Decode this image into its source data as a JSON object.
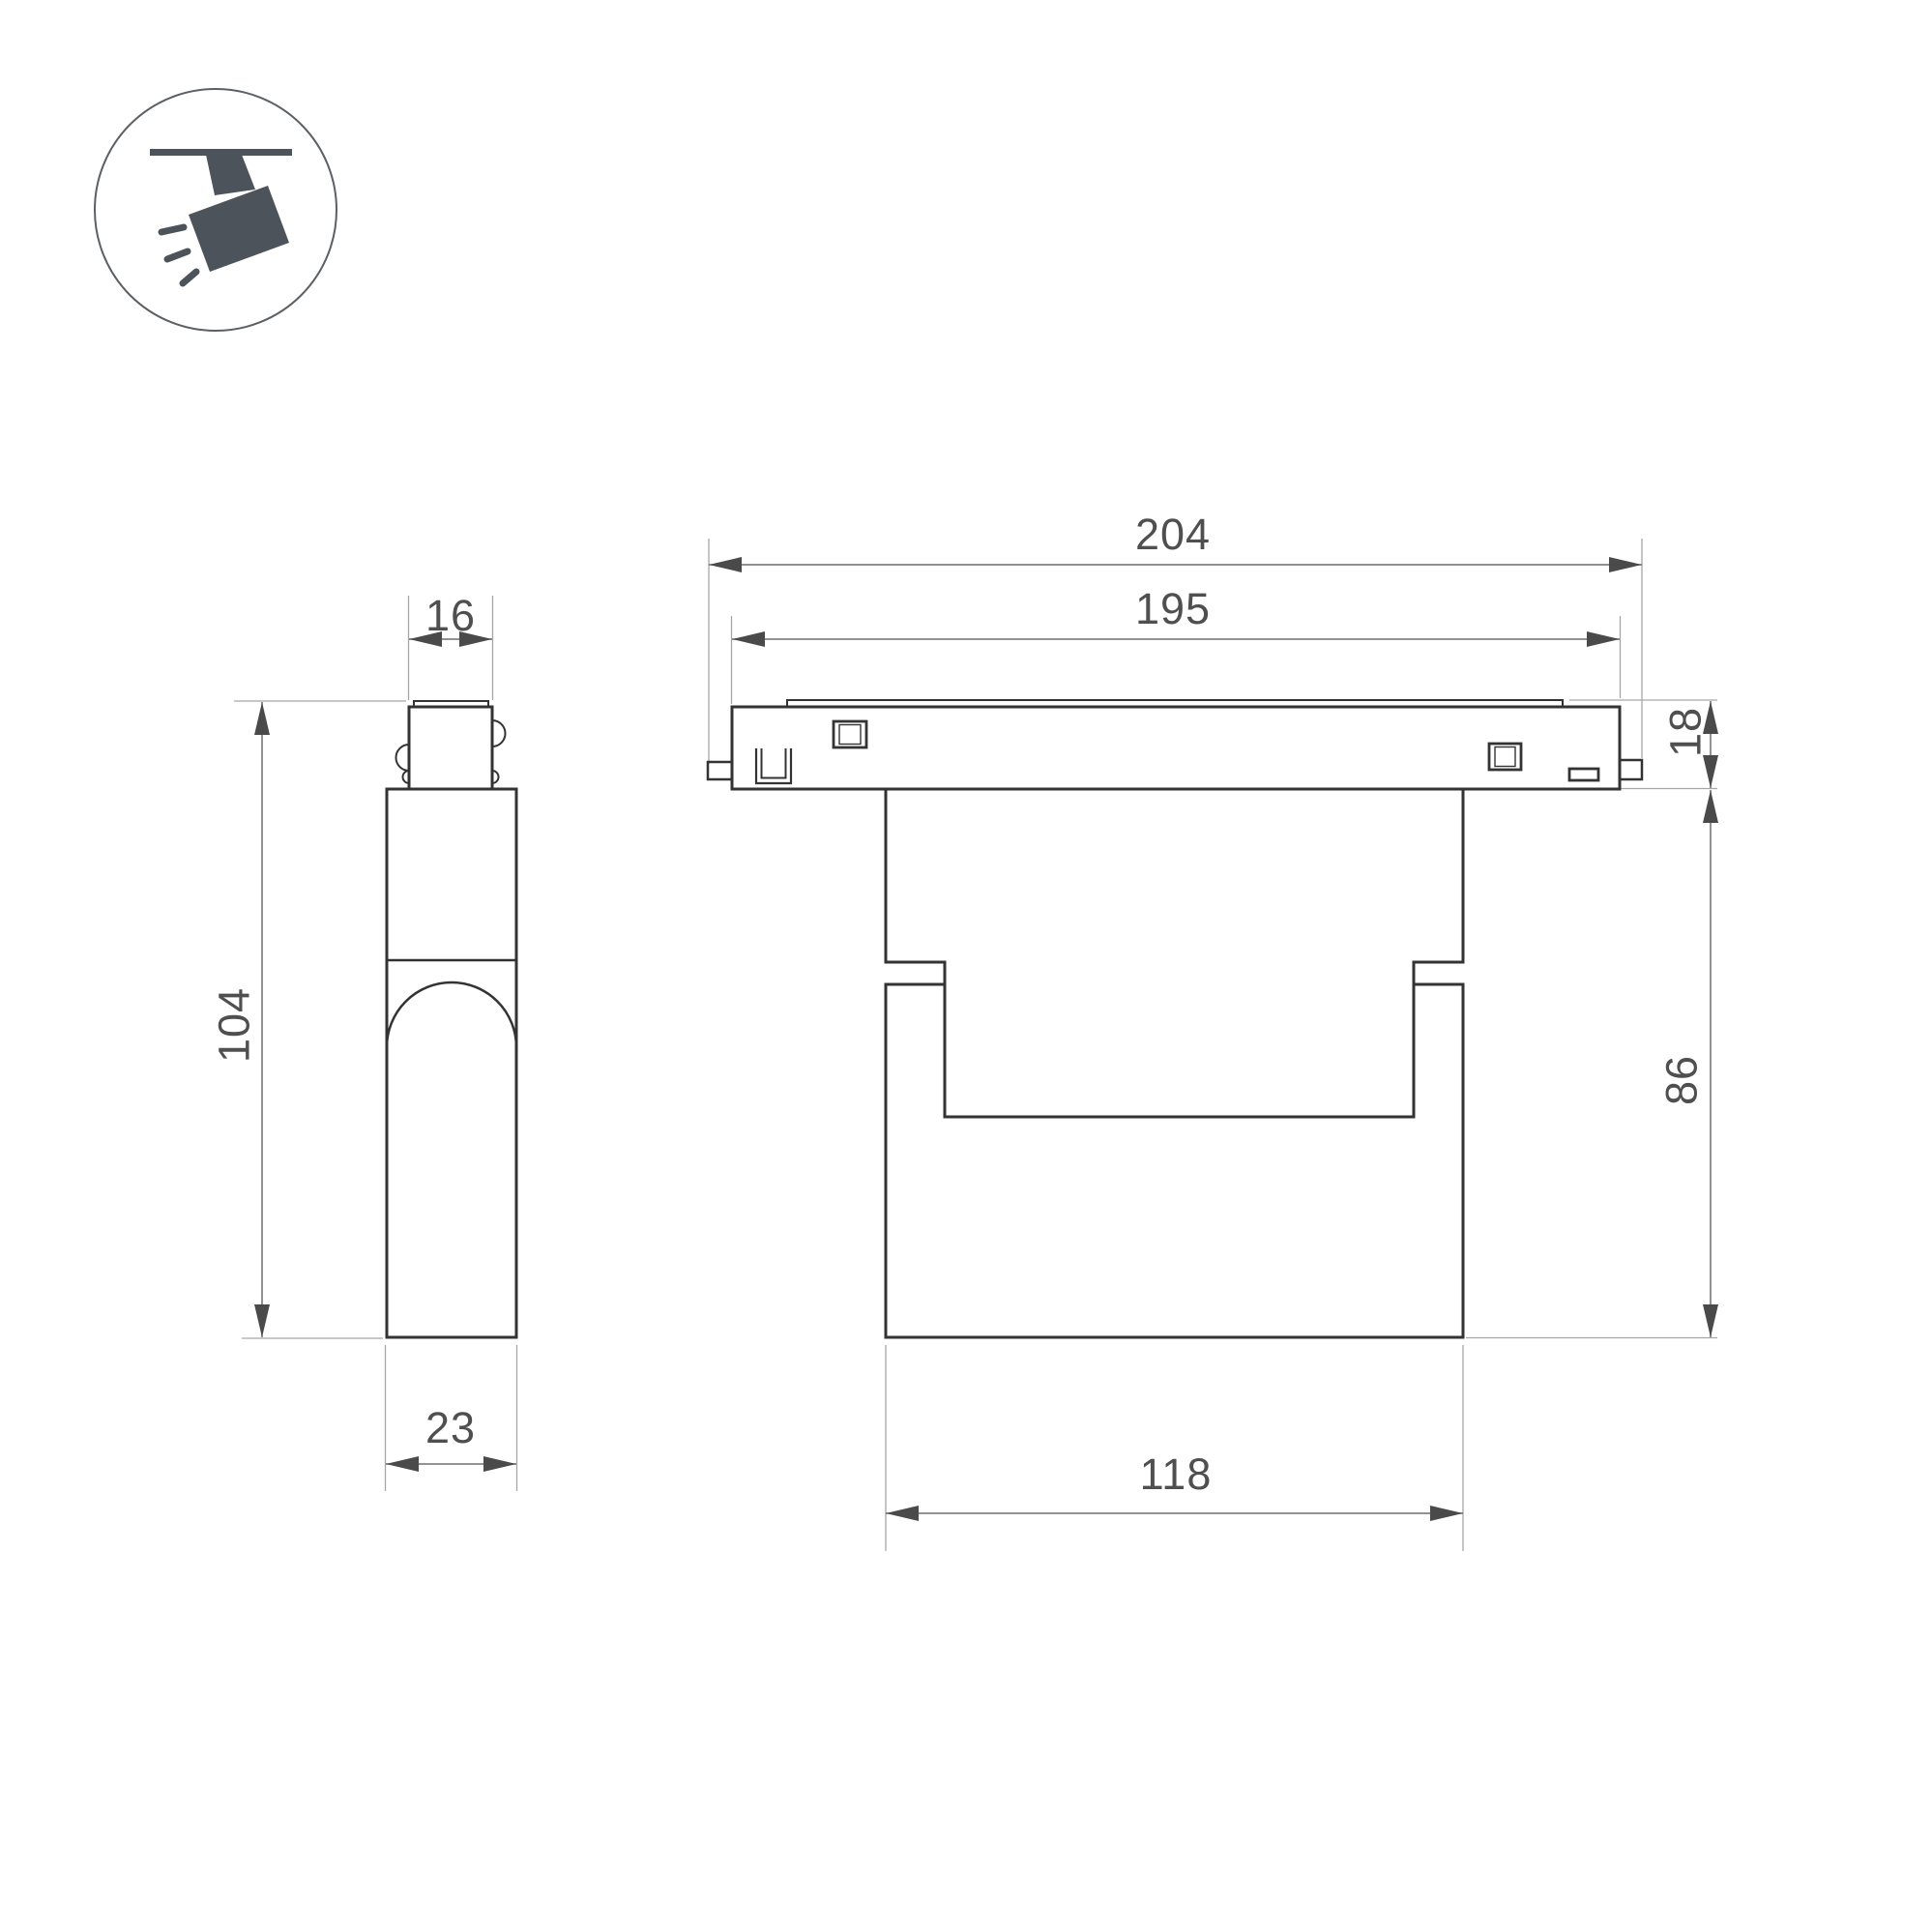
{
  "icon": {
    "name": "track-spotlight-icon",
    "color": "#4d535a",
    "ring_color": "#5b6065"
  },
  "colors": {
    "background": "#ffffff",
    "outline": "#333333",
    "dim_line": "#6f6f6f",
    "ext_line": "#a6a6a6",
    "arrow": "#4a4a4a",
    "label": "#4f4f4f"
  },
  "views": {
    "side": {
      "dims": {
        "top_width": "16",
        "height": "104",
        "bottom_width": "23"
      }
    },
    "front": {
      "dims": {
        "overall_width": "204",
        "inner_width": "195",
        "track_height": "18",
        "body_height": "86",
        "bottom_width": "118"
      }
    }
  }
}
